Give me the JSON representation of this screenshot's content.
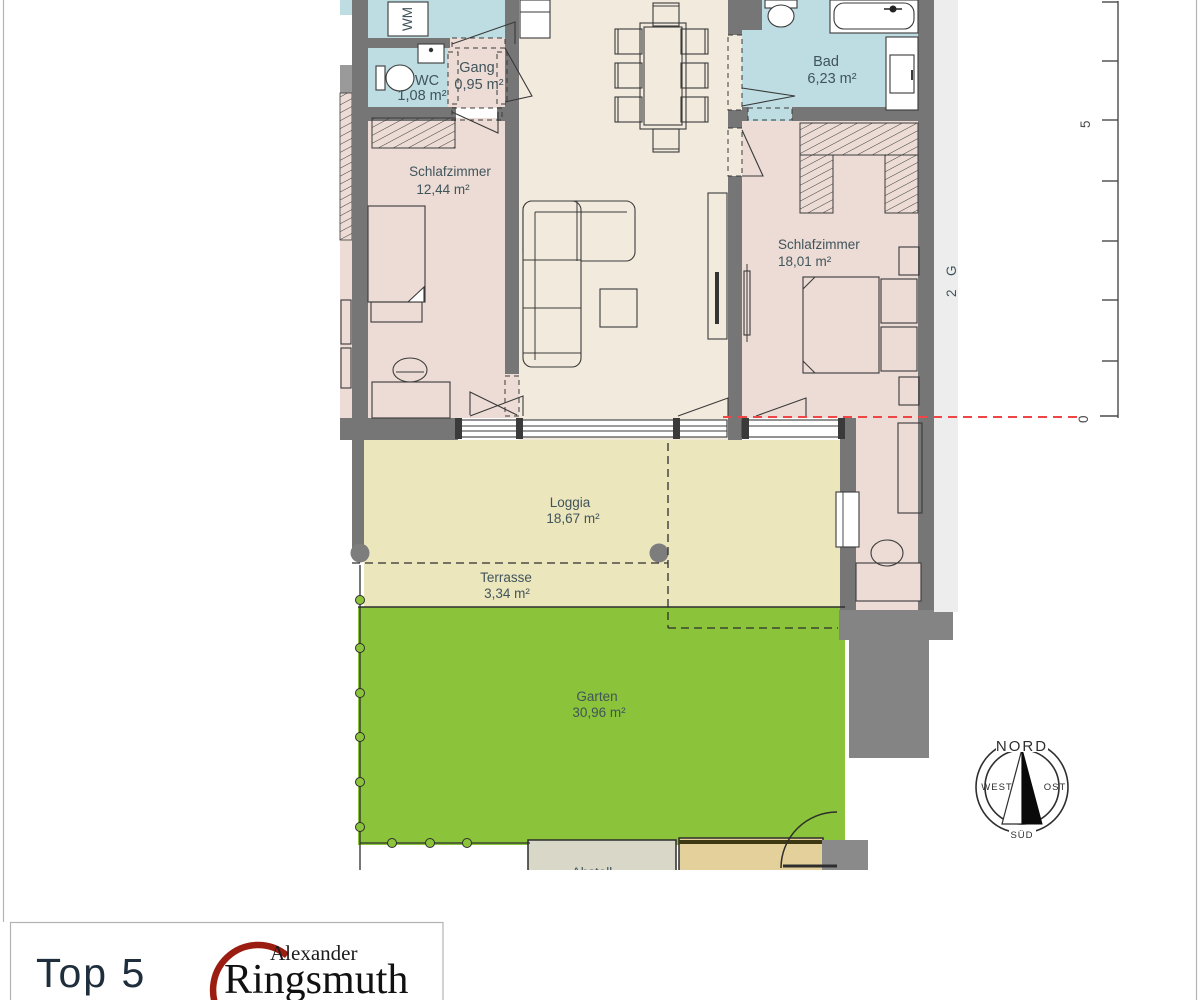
{
  "plan": {
    "labels": {
      "wm": "WM",
      "wc": {
        "name": "WC",
        "area": "1,08 m²"
      },
      "gang": {
        "name": "Gang",
        "area": "0,95 m²"
      },
      "schlafzimmer_left": {
        "name": "Schlafzimmer",
        "area": "12,44 m²"
      },
      "bad": {
        "name": "Bad",
        "area": "6,23 m²"
      },
      "schlafzimmer_right": {
        "name": "Schlafzimmer",
        "area": "18,01 m²"
      },
      "loggia": {
        "name": "Loggia",
        "area": "18,67 m²"
      },
      "terrasse": {
        "name": "Terrasse",
        "area": "3,34 m²"
      },
      "garten": {
        "name": "Garten",
        "area": "30,96 m²"
      },
      "storage_partial": "Abstell",
      "edge_fragment_char1": "G",
      "edge_fragment_char2": "2"
    },
    "colors": {
      "wall": "#767676",
      "room_pink": "#ecdcd5",
      "wet_room_blue": "#bedde2",
      "living_cream": "#f3eade",
      "loggia_cream": "#ece6bd",
      "garden_green": "#8bc43a",
      "storage_gray": "#d9d8c8",
      "storage_tan": "#e4d09a",
      "section_line_red": "#f04545",
      "label_teal": "#40545b"
    }
  },
  "ruler": {
    "label_5": "5",
    "label_0": "0"
  },
  "compass": {
    "north": "NORD",
    "east": "OST",
    "south": "SÜD",
    "west": "WEST"
  },
  "footer": {
    "unit_label": "Top 5",
    "brand_first_name": "Alexander",
    "brand_last_name": "Ringsmuth",
    "brand_red": "#9b1c10",
    "unit_navy": "#1f2e3c"
  }
}
